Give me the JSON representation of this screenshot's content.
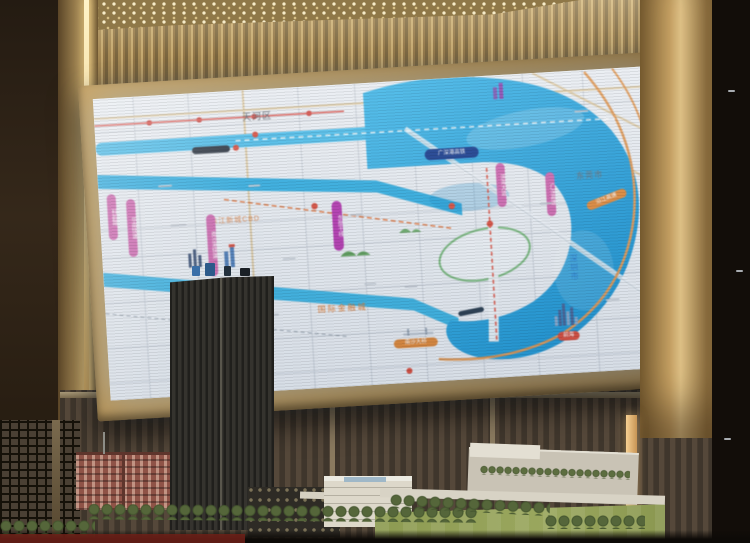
{
  "scene_labels": {
    "district_top": "天河区",
    "city_dongguan": "东莞市",
    "city_shenzhen": "深圳市",
    "area_financial_city": "国际金融城",
    "area_cbd": "珠江新城CBD",
    "area_qianhai": "前海"
  },
  "capsules": {
    "rail_blue": "广深港高铁",
    "bridge_orange": "南沙大桥",
    "highway_orange": "沿江高速",
    "pink_roads": [
      "科韵路",
      "华南快速",
      "南沙港快速",
      "东部干线",
      "滨海大道",
      "广深高速"
    ]
  },
  "colors": {
    "water": "#35aee0",
    "bay_deep": "#1d93d2",
    "land": "#e9edf2",
    "pink_capsule": "#d06ab0",
    "orange_oval": "#e08a3c",
    "rail_capsule_blue": "#1c3f8f",
    "metro_red": "#d4514a",
    "frame_gold": "#b5914f",
    "slat_wood": "#b89a64",
    "model_tower": "#2a2925"
  }
}
